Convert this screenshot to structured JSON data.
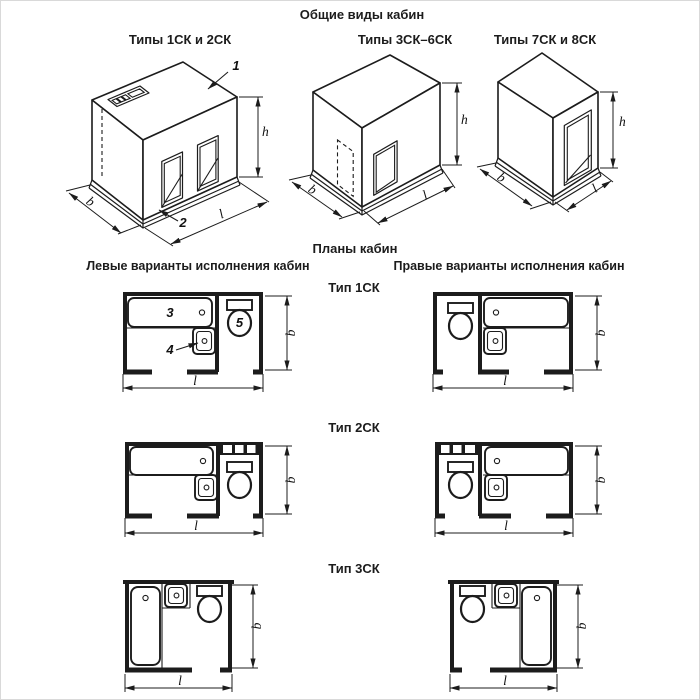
{
  "document": {
    "background": "#ffffff",
    "ink": "#1c1c1c"
  },
  "general_views": {
    "title": "Общие виды кабин",
    "figures": [
      {
        "caption": "Типы 1СК и 2СК",
        "callout_roof": "1",
        "callout_base": "2",
        "dim_height": "h",
        "dim_depth": "b",
        "dim_length": "l"
      },
      {
        "caption": "Типы 3СК–6СК",
        "dim_height": "h",
        "dim_depth": "b",
        "dim_length": "l"
      },
      {
        "caption": "Типы 7СК и 8СК",
        "dim_height": "h",
        "dim_depth": "b",
        "dim_length": "l"
      }
    ]
  },
  "plans": {
    "title": "Планы кабин",
    "left_column_header": "Левые варианты исполнения кабин",
    "right_column_header": "Правые варианты исполнения кабин",
    "rows": [
      {
        "label": "Тип 1СК",
        "callout_bath": "3",
        "callout_washbasin": "4",
        "callout_toilet": "5",
        "dim_width": "b",
        "dim_length": "l"
      },
      {
        "label": "Тип 2СК",
        "dim_width": "b",
        "dim_length": "l"
      },
      {
        "label": "Тип 3СК",
        "dim_width": "b",
        "dim_length": "l"
      }
    ]
  }
}
